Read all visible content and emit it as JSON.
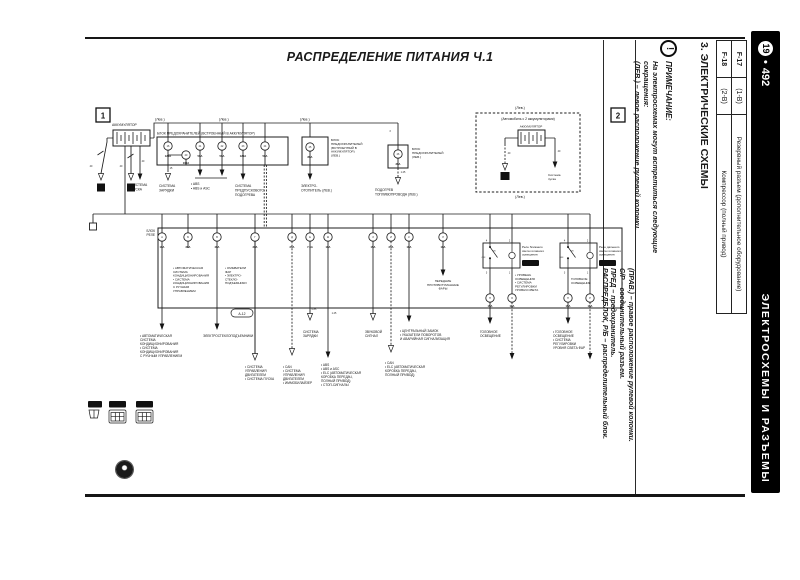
{
  "colors": {
    "ink": "#1a1a1a",
    "paper": "#ffffff",
    "bar_bg": "#000000",
    "bar_fg": "#ffffff"
  },
  "page": {
    "title": "РАСПРЕДЕЛЕНИЕ ПИТАНИЯ Ч.1",
    "section_heading": "3. ЭЛЕКТРИЧЕСКИЕ СХЕМЫ"
  },
  "bar": {
    "page_chapter": "19",
    "page_sep": "•",
    "page_number": "492",
    "title": "ЭЛЕКТРОСХЕМЫ И РАЗЪЕМЫ"
  },
  "note": {
    "icon": "warning-exclamation",
    "heading": "ПРИМЕЧАНИЕ:",
    "block1": [
      "На электросхемах могут встретиться следующие",
      "сокращения:",
      "(ЛЕВ.) – левое расположение рулевой колонки."
    ],
    "block2": [
      "(ПРАВ.) – правое расположение рулевой колонки.",
      "С/Р – соединительный разъем.",
      "ПРЕД – предохранитель.",
      "РАСПРЕДБЛОК, Р/Б – распределительный блок."
    ]
  },
  "ref_table": {
    "rows": [
      {
        "id": "F-17",
        "loc": "(1-B)",
        "desc": "Резервный разъем (дополнительное оборудование)"
      },
      {
        "id": "F-18",
        "loc": "(2-B)",
        "desc": "Компрессор (полный привод)"
      }
    ]
  },
  "diagram": {
    "markers": [
      {
        "x": 11,
        "y": 16,
        "t": "1"
      },
      {
        "x": 526,
        "y": 16,
        "t": "2"
      }
    ],
    "ground_squares": [
      {
        "x": 12,
        "y": 91.5,
        "w": 8,
        "t": "4"
      },
      {
        "x": 42,
        "y": 91.5,
        "w": 8,
        "t": "3"
      },
      {
        "x": 415.5,
        "y": 80,
        "w": 9,
        "t": "10"
      }
    ],
    "badges": [
      {
        "x": 437,
        "y": 168,
        "w": 17,
        "h": 6,
        "t": "А-220",
        "style": "dark"
      },
      {
        "x": 514,
        "y": 168,
        "w": 17,
        "h": 6,
        "t": "А-218",
        "style": "dark"
      },
      {
        "x": 146,
        "y": 217,
        "w": 22,
        "h": 8,
        "t": "А-12",
        "style": "oval"
      },
      {
        "x": 3,
        "y": 309,
        "w": 14,
        "h": 6.5,
        "t": "А-12",
        "style": "dark"
      },
      {
        "x": 24,
        "y": 309,
        "w": 17,
        "h": 6.5,
        "t": "А-220",
        "style": "dark"
      },
      {
        "x": 51,
        "y": 309,
        "w": 17,
        "h": 6.5,
        "t": "А-230",
        "style": "dark"
      }
    ],
    "fuses": [
      {
        "x": 83,
        "y": 54,
        "id": "16",
        "r": "120А"
      },
      {
        "x": 101,
        "y": 63,
        "id": "20",
        "r": "100А",
        "ry": 72
      },
      {
        "x": 115,
        "y": 54,
        "id": "21",
        "r": "50А"
      },
      {
        "x": 137,
        "y": 54,
        "id": "22",
        "r": "50А"
      },
      {
        "x": 158,
        "y": 54,
        "id": "23",
        "r": "120А"
      },
      {
        "x": 180,
        "y": 54,
        "id": "24",
        "r": "50А"
      },
      {
        "x": 225,
        "y": 55,
        "id": "25",
        "r": "80А"
      },
      {
        "x": 313,
        "y": 62,
        "id": "26",
        "r": "30А",
        "ry": 73
      },
      {
        "x": 77,
        "y": 145,
        "id": "А",
        "r": "10А"
      },
      {
        "x": 103,
        "y": 145,
        "id": "Б",
        "r": "20А"
      },
      {
        "x": 132,
        "y": 145,
        "id": "В",
        "r": "40А"
      },
      {
        "x": 170,
        "y": 145,
        "id": "Г",
        "r": "30А"
      },
      {
        "x": 207,
        "y": 145,
        "id": "Д",
        "r": "20А"
      },
      {
        "x": 225,
        "y": 145,
        "id": "Е",
        "r": "7.5А"
      },
      {
        "x": 243,
        "y": 145,
        "id": "Ж",
        "r": "10А"
      },
      {
        "x": 288,
        "y": 145,
        "id": "З",
        "r": "15А"
      },
      {
        "x": 306,
        "y": 145,
        "id": "И",
        "r": "20А"
      },
      {
        "x": 324,
        "y": 145,
        "id": "К",
        "r": "10А"
      },
      {
        "x": 358,
        "y": 145,
        "id": "Л",
        "r": "10А"
      },
      {
        "x": 405,
        "y": 206,
        "id": "Н",
        "r": "15А",
        "ry": 214.8
      },
      {
        "x": 427,
        "y": 206,
        "id": "О",
        "r": "10А",
        "ry": 214.8
      },
      {
        "x": 483,
        "y": 206,
        "id": "П",
        "r": "15А",
        "ry": 214.8
      },
      {
        "x": 505,
        "y": 206,
        "id": "Р",
        "r": "15А",
        "ry": 214.8
      }
    ],
    "labels": [
      {
        "x": 27,
        "y": 34,
        "s": 3.4,
        "lines": [
          "АККУМУЛЯТОР"
        ]
      },
      {
        "x": 70,
        "y": 28.5,
        "s": 3.6,
        "lines": [
          "(Лев.)"
        ]
      },
      {
        "x": 134,
        "y": 28.5,
        "s": 3.6,
        "lines": [
          "(Лев.)"
        ]
      },
      {
        "x": 215,
        "y": 28.5,
        "s": 3.6,
        "lines": [
          "(Лев.)"
        ]
      },
      {
        "x": 72,
        "y": 42.5,
        "s": 3.3,
        "lines": [
          "БЛОК ПРЕДОХРАНИТЕЛЕЙ (ВСТРОЕННЫЙ В АККУМУЛЯТОР)"
        ]
      },
      {
        "x": 246,
        "y": 49,
        "s": 3.1,
        "lh": 3.9,
        "lines": [
          "БЛОК",
          "ПРЕДОХРАНИТЕЛЕЙ",
          "(ВСТРОЕННЫЙ В",
          "АККУМУЛЯТОР)",
          "(ЛЕВ.)"
        ]
      },
      {
        "x": 327,
        "y": 58,
        "s": 3.1,
        "lh": 3.9,
        "lines": [
          "БЛОК",
          "ПРЕДОХРАНИТЕЛЕЙ",
          "(ЛЕВ.)"
        ]
      },
      {
        "x": 46,
        "y": 94,
        "s": 3.3,
        "lines": [
          "СИСТЕМА",
          "ПУСКА"
        ]
      },
      {
        "x": 74,
        "y": 95,
        "s": 3.3,
        "lines": [
          "СИСТЕМА",
          "ЗАРЯДКИ"
        ]
      },
      {
        "x": 106,
        "y": 93,
        "s": 3.3,
        "lines": [
          "• ABS",
          "• ABS и ASC"
        ]
      },
      {
        "x": 150,
        "y": 95,
        "s": 3.3,
        "lines": [
          "СИСТЕМА",
          "ПРЕДПУСКОВОГО",
          "ПОДОГРЕВА"
        ]
      },
      {
        "x": 216,
        "y": 95,
        "s": 3.3,
        "lines": [
          "ЭЛЕКТРО-",
          "ОТОПИТЕЛЬ (ЛЕВ.)"
        ]
      },
      {
        "x": 290,
        "y": 99,
        "s": 3.3,
        "lines": [
          "ПОДОГРЕВ",
          "ТОПЛИВОПРОВОДА (ЛЕВ.)"
        ]
      },
      {
        "x": 70,
        "y": 140,
        "s": 3.2,
        "a": "end",
        "lines": [
          "БЛОК",
          "РЕЛЕ"
        ],
        "lh": 3.9
      },
      {
        "x": 88,
        "y": 177,
        "s": 3,
        "lh": 3.8,
        "lines": [
          "• АВТОМАТИЧЕСКАЯ",
          "СИСТЕМА",
          "КОНДИЦИОНИРОВАНИЯ",
          "• СИСТЕМА",
          "КОНДИЦИОНИРОВАНИЯ",
          "С РУЧНЫМ",
          "УПРАВЛЕНИЕМ"
        ]
      },
      {
        "x": 140,
        "y": 177,
        "s": 3,
        "lh": 3.8,
        "lines": [
          "• ОМЫВАТЕЛИ",
          "ФАР",
          "• ЭЛЕКТРО-",
          "СТЕКЛО-",
          "ПОДЪЕМНИКИ"
        ]
      },
      {
        "x": 358,
        "y": 190,
        "s": 3,
        "a": "middle",
        "lh": 3.8,
        "lines": [
          "ПЕРЕДНИЕ",
          "ПРОТИВОТУМАННЫЕ",
          "ФАРЫ"
        ]
      },
      {
        "x": 437,
        "y": 156,
        "s": 3,
        "lh": 3.8,
        "lines": [
          "Реле ближнего",
          "света головного",
          "освещения"
        ]
      },
      {
        "x": 514,
        "y": 156,
        "s": 3,
        "lh": 3.8,
        "lines": [
          "Реле дальнего",
          "света головного",
          "освещения"
        ]
      },
      {
        "x": 430,
        "y": 184,
        "s": 3,
        "lh": 3.8,
        "lines": [
          "• УРОВЕНЬ",
          "ОСВЕЩЕНИЯ",
          "• СИСТЕМА",
          "РЕГУЛИРОВКИ",
          "УРОВНЯ СВЕТА"
        ]
      },
      {
        "x": 486,
        "y": 188,
        "s": 3,
        "lh": 3.8,
        "lines": [
          "ГОЛОВНОЕ",
          "ОСВЕЩЕНИЕ"
        ]
      },
      {
        "x": 55,
        "y": 245,
        "s": 3.2,
        "lh": 4,
        "lines": [
          "• АВТОМАТИЧЕСКАЯ",
          "СИСТЕМА",
          "КОНДИЦИОНИРОВАНИЯ",
          "• СИСТЕМА",
          "КОНДИЦИОНИРОВАНИЯ",
          "С РУЧНЫМ УПРАВЛЕНИЕМ"
        ]
      },
      {
        "x": 118,
        "y": 245,
        "s": 3.2,
        "lines": [
          "ЭЛЕКТРОСТЕКЛОПОДЪЕМНИКИ"
        ]
      },
      {
        "x": 160,
        "y": 276,
        "s": 3.2,
        "lh": 4,
        "lines": [
          "• СИСТЕМА",
          "УПРАВЛЕНИЯ",
          "ДВИГАТЕЛЕМ",
          "• СИСТЕМА ПУСКА"
        ]
      },
      {
        "x": 198,
        "y": 276,
        "s": 3.2,
        "lh": 4,
        "lines": [
          "• CAN",
          "• СИСТЕМА",
          "УПРАВЛЕНИЯ",
          "ДВИГАТЕЛЕМ",
          "• ИММОБИЛАЙЗЕР"
        ]
      },
      {
        "x": 218,
        "y": 241,
        "s": 3.2,
        "lh": 4,
        "lines": [
          "СИСТЕМА",
          "ЗАРЯДКИ"
        ]
      },
      {
        "x": 236,
        "y": 274,
        "s": 3.2,
        "lh": 4,
        "lines": [
          "• ABS",
          "• ABS и ASC",
          "• ELC (АВТОМАТИЧЕСКАЯ",
          "КОРОБКА ПЕРЕДАЧ,",
          "ПОЛНЫЙ ПРИВОД)",
          "• СТОП-СИГНАЛЫ"
        ]
      },
      {
        "x": 280,
        "y": 241,
        "s": 3.2,
        "lh": 4,
        "lines": [
          "ЗВУКОВОЙ",
          "СИГНАЛ"
        ]
      },
      {
        "x": 315,
        "y": 240,
        "s": 3.2,
        "lh": 4,
        "lines": [
          "• ЦЕНТРАЛЬНЫЙ ЗАМОК",
          "• УКАЗАТЕЛИ ПОВОРОТОВ",
          "И АВАРИЙНАЯ СИГНАЛИЗАЦИЯ"
        ]
      },
      {
        "x": 300,
        "y": 272,
        "s": 3.2,
        "lh": 4,
        "lines": [
          "• CAN",
          "• ELC (АВТОМАТИЧЕСКАЯ",
          "КОРОБКА ПЕРЕДАЧ,",
          "ПОЛНЫЙ ПРИВОД)"
        ]
      },
      {
        "x": 395,
        "y": 241,
        "s": 3.2,
        "lh": 4,
        "lines": [
          "ГОЛОВНОЕ",
          "ОСВЕЩЕНИЕ"
        ]
      },
      {
        "x": 468,
        "y": 241,
        "s": 3.2,
        "lh": 4,
        "lines": [
          "• ГОЛОВНОЕ",
          "ОСВЕЩЕНИЕ",
          "• СИСТЕМА",
          "РЕГУЛИРОВКИ",
          "УРОВНЯ СВЕТА ФАР"
        ]
      },
      {
        "x": 443,
        "y": 28,
        "s": 3.4,
        "a": "middle",
        "lines": [
          "(Автомобиль с 2 аккумуляторами)"
        ]
      },
      {
        "x": 446,
        "y": 35.5,
        "s": 3.1,
        "a": "middle",
        "lines": [
          "АККУМУЛЯТОР"
        ]
      },
      {
        "x": 463,
        "y": 84,
        "s": 3.1,
        "lh": 3.8,
        "lines": [
          "Система",
          "пуска"
        ]
      },
      {
        "x": 435,
        "y": 17,
        "s": 3.6,
        "a": "middle",
        "lines": [
          "(Лев.)"
        ]
      },
      {
        "x": 435,
        "y": 106,
        "s": 3.6,
        "a": "middle",
        "lines": [
          "(Лев.)"
        ]
      }
    ],
    "tiny": [
      {
        "x": 6,
        "y": 75,
        "t": "40"
      },
      {
        "x": 36,
        "y": 75,
        "t": "40"
      },
      {
        "x": 58,
        "y": 70,
        "t": "40"
      },
      {
        "x": 86,
        "y": 77,
        "t": "15"
      },
      {
        "x": 305,
        "y": 40,
        "t": "3"
      },
      {
        "x": 318,
        "y": 81,
        "t": "1.25"
      },
      {
        "x": 229,
        "y": 218,
        "t": "0.85"
      },
      {
        "x": 249,
        "y": 222,
        "t": "1.25"
      },
      {
        "x": 424,
        "y": 62,
        "t": "40"
      },
      {
        "x": 474,
        "y": 60,
        "t": "40"
      },
      {
        "x": 401.5,
        "y": 149.5,
        "t": "4"
      },
      {
        "x": 424.5,
        "y": 149.5,
        "t": "2"
      },
      {
        "x": 401.5,
        "y": 181.5,
        "t": "3"
      },
      {
        "x": 424.5,
        "y": 181.5,
        "t": "1"
      },
      {
        "x": 479.5,
        "y": 149.5,
        "t": "4"
      },
      {
        "x": 502.5,
        "y": 149.5,
        "t": "2"
      },
      {
        "x": 479.5,
        "y": 181.5,
        "t": "3"
      },
      {
        "x": 502.5,
        "y": 181.5,
        "t": "1"
      },
      {
        "x": 398.5,
        "y": 166,
        "t": "OFF",
        "s": 2
      },
      {
        "x": 409,
        "y": 159.5,
        "t": "ON",
        "s": 2
      },
      {
        "x": 476.5,
        "y": 166,
        "t": "OFF",
        "s": 2
      },
      {
        "x": 487,
        "y": 159.5,
        "t": "ON",
        "s": 2
      }
    ]
  }
}
